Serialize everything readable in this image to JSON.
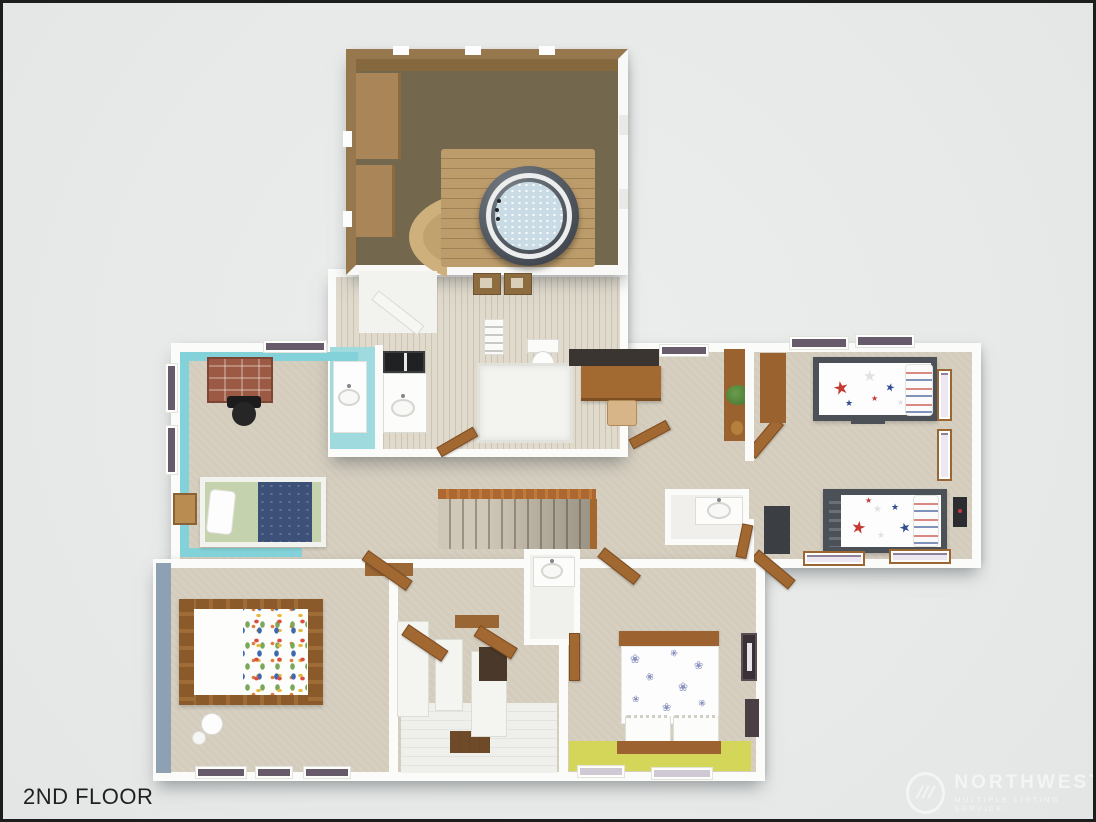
{
  "title": {
    "text": "2ND FLOOR"
  },
  "watermark": {
    "name": "NORTHWEST",
    "tagline": "MULTIPLE LISTING SERVICE.",
    "logo_glyph": "///"
  },
  "icons": {
    "star": "★",
    "flower": "❀"
  },
  "palette": {
    "page_background": "#e8eaea",
    "frame_border": "#1c1e1e",
    "wall_white": "#fbfbf9",
    "carpet_beige": "#d6cfc0",
    "bonus_room_carpet": "#73674e",
    "wood_wall": "#96774e",
    "deck_wood": "#bc9c6b",
    "hot_tub_shell": "#4a4f57",
    "hot_tub_water": "#c9dbe4",
    "cyan_bedroom_wall": "#84d2d9",
    "cyan_bath_floor": "#9edade",
    "primary_accent_wall": "#8da1b2",
    "yellow_accent": "#d4d65a",
    "door_wood": "#a26832",
    "stair_banister": "#ad6831",
    "bed_green": "#c5d2ae",
    "bed_navy": "#3d5078",
    "star_red": "#c43b35",
    "star_blue": "#2f4d8f",
    "desk_brick": "#9c5a44",
    "desk_wood": "#a26a31",
    "bed_frame_gray": "#4c5157"
  },
  "rooms": [
    {
      "name": "bonus-room",
      "features": "hot-tub, wood deck, built-in benches"
    },
    {
      "name": "main-bathroom",
      "features": "double vanity, toilet, walk-in shower, towel ladder"
    },
    {
      "name": "bedroom-left",
      "features": "twin bed, brick desk, office chair, nightstand"
    },
    {
      "name": "primary-bedroom",
      "features": "log bed, confetti quilt, floor lamp"
    },
    {
      "name": "hallway",
      "features": "staircase, doors"
    },
    {
      "name": "office-nook",
      "features": "desk, chair, bookshelf, plant"
    },
    {
      "name": "bedroom-right",
      "features": "two star-pattern twin beds, wardrobes"
    },
    {
      "name": "bedroom-middle",
      "features": "floral bed, wall art, yellow accent floor"
    },
    {
      "name": "closet-area",
      "features": "white shelving, wood mat, powder sink"
    }
  ]
}
